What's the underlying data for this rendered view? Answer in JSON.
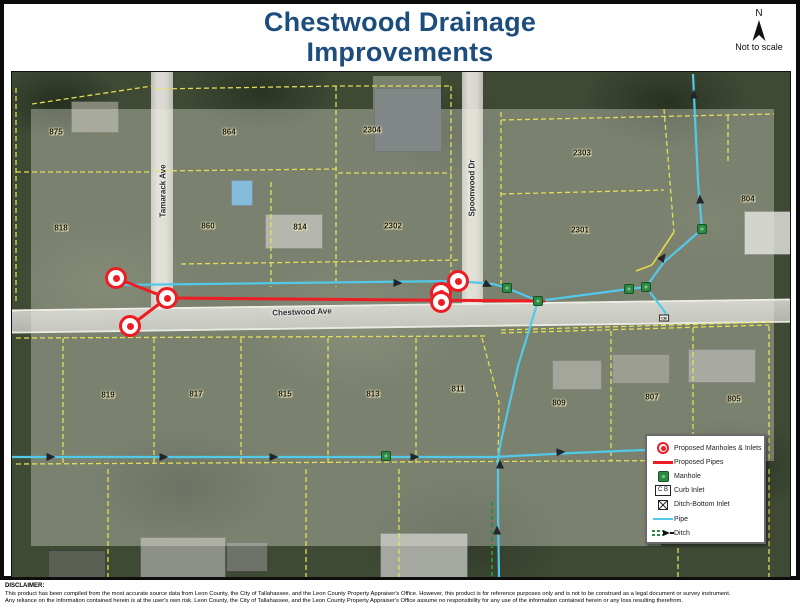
{
  "title": {
    "line1": "Chestwood Drainage",
    "line2": "Improvements"
  },
  "north_arrow": {
    "label": "N",
    "note": "Not to scale"
  },
  "legend": {
    "items": [
      {
        "label": "Proposed Manholes & Inlets"
      },
      {
        "label": "Proposed Pipes"
      },
      {
        "label": "Manhole"
      },
      {
        "label": "Curb Inlet",
        "symbol_text": "C B"
      },
      {
        "label": "Ditch-Bottom Inlet"
      },
      {
        "label": "Pipe"
      },
      {
        "label": "Ditch"
      }
    ]
  },
  "map": {
    "streets": [
      {
        "label": "Tamarack Ave",
        "x": 151,
        "y": 119,
        "rotation": -90
      },
      {
        "label": "Spoonwood Dr",
        "x": 460,
        "y": 116,
        "rotation": -90
      },
      {
        "label": "Chestwood Ave",
        "x": 290,
        "y": 240,
        "rotation": -2
      }
    ],
    "parcels": [
      {
        "label": "875",
        "x": 44,
        "y": 60
      },
      {
        "label": "864",
        "x": 217,
        "y": 60
      },
      {
        "label": "2304",
        "x": 360,
        "y": 58
      },
      {
        "label": "2303",
        "x": 570,
        "y": 81
      },
      {
        "label": "804",
        "x": 736,
        "y": 127
      },
      {
        "label": "818",
        "x": 49,
        "y": 156
      },
      {
        "label": "860",
        "x": 196,
        "y": 154
      },
      {
        "label": "814",
        "x": 288,
        "y": 155
      },
      {
        "label": "2302",
        "x": 381,
        "y": 154
      },
      {
        "label": "2301",
        "x": 568,
        "y": 158
      },
      {
        "label": "819",
        "x": 96,
        "y": 323
      },
      {
        "label": "817",
        "x": 184,
        "y": 322
      },
      {
        "label": "815",
        "x": 273,
        "y": 322
      },
      {
        "label": "813",
        "x": 361,
        "y": 322
      },
      {
        "label": "811",
        "x": 446,
        "y": 317
      },
      {
        "label": "809",
        "x": 547,
        "y": 331
      },
      {
        "label": "807",
        "x": 640,
        "y": 325
      },
      {
        "label": "805",
        "x": 722,
        "y": 327
      }
    ],
    "existing_manholes": [
      {
        "x": 374,
        "y": 384
      },
      {
        "x": 495,
        "y": 216
      },
      {
        "x": 526,
        "y": 229
      },
      {
        "x": 617,
        "y": 217
      },
      {
        "x": 634,
        "y": 215
      },
      {
        "x": 690,
        "y": 157
      }
    ],
    "proposed_manholes": [
      {
        "x": 104,
        "y": 206
      },
      {
        "x": 155,
        "y": 226
      },
      {
        "x": 118,
        "y": 254
      },
      {
        "x": 446,
        "y": 209
      },
      {
        "x": 429,
        "y": 221
      },
      {
        "x": 429,
        "y": 230
      }
    ],
    "curb_inlet": {
      "x": 652,
      "y": 246,
      "label": "CB"
    },
    "flow_arrows": [
      {
        "x": 386,
        "y": 211,
        "angle": 2
      },
      {
        "x": 476,
        "y": 213,
        "angle": 25
      },
      {
        "x": 651,
        "y": 185,
        "angle": -55
      },
      {
        "x": 688,
        "y": 127,
        "angle": -93
      },
      {
        "x": 682,
        "y": 22,
        "angle": -92
      },
      {
        "x": 488,
        "y": 392,
        "angle": -90
      },
      {
        "x": 485,
        "y": 458,
        "angle": -90
      },
      {
        "x": 39,
        "y": 385,
        "angle": 0
      },
      {
        "x": 152,
        "y": 385,
        "angle": 0
      },
      {
        "x": 262,
        "y": 385,
        "angle": 0
      },
      {
        "x": 403,
        "y": 385,
        "angle": 0
      },
      {
        "x": 549,
        "y": 380,
        "angle": -3
      }
    ]
  },
  "colors": {
    "title_navy": "#1d4d7c",
    "proposed_red": "#ee1c23",
    "pipe_cyan": "#53c9e9",
    "parcel_yellow": "#e8e455",
    "manhole_green": "#2e8b42"
  },
  "disclaimer": {
    "heading": "DISCLAIMER:",
    "line1": "This product has been compiled from the most accurate source data from Leon County, the City of Tallahassee, and the Leon County Property Appraiser's Office. However, this product is for reference purposes only and is not to be construed as a legal document or survey instrument.",
    "line2": "Any reliance on the information contained herein is at the user's own risk. Leon County, the City of Tallahassee, and the Leon County Property Appraiser's Office assume no responsibility for any use of the information contained herein or any loss resulting therefrom."
  }
}
